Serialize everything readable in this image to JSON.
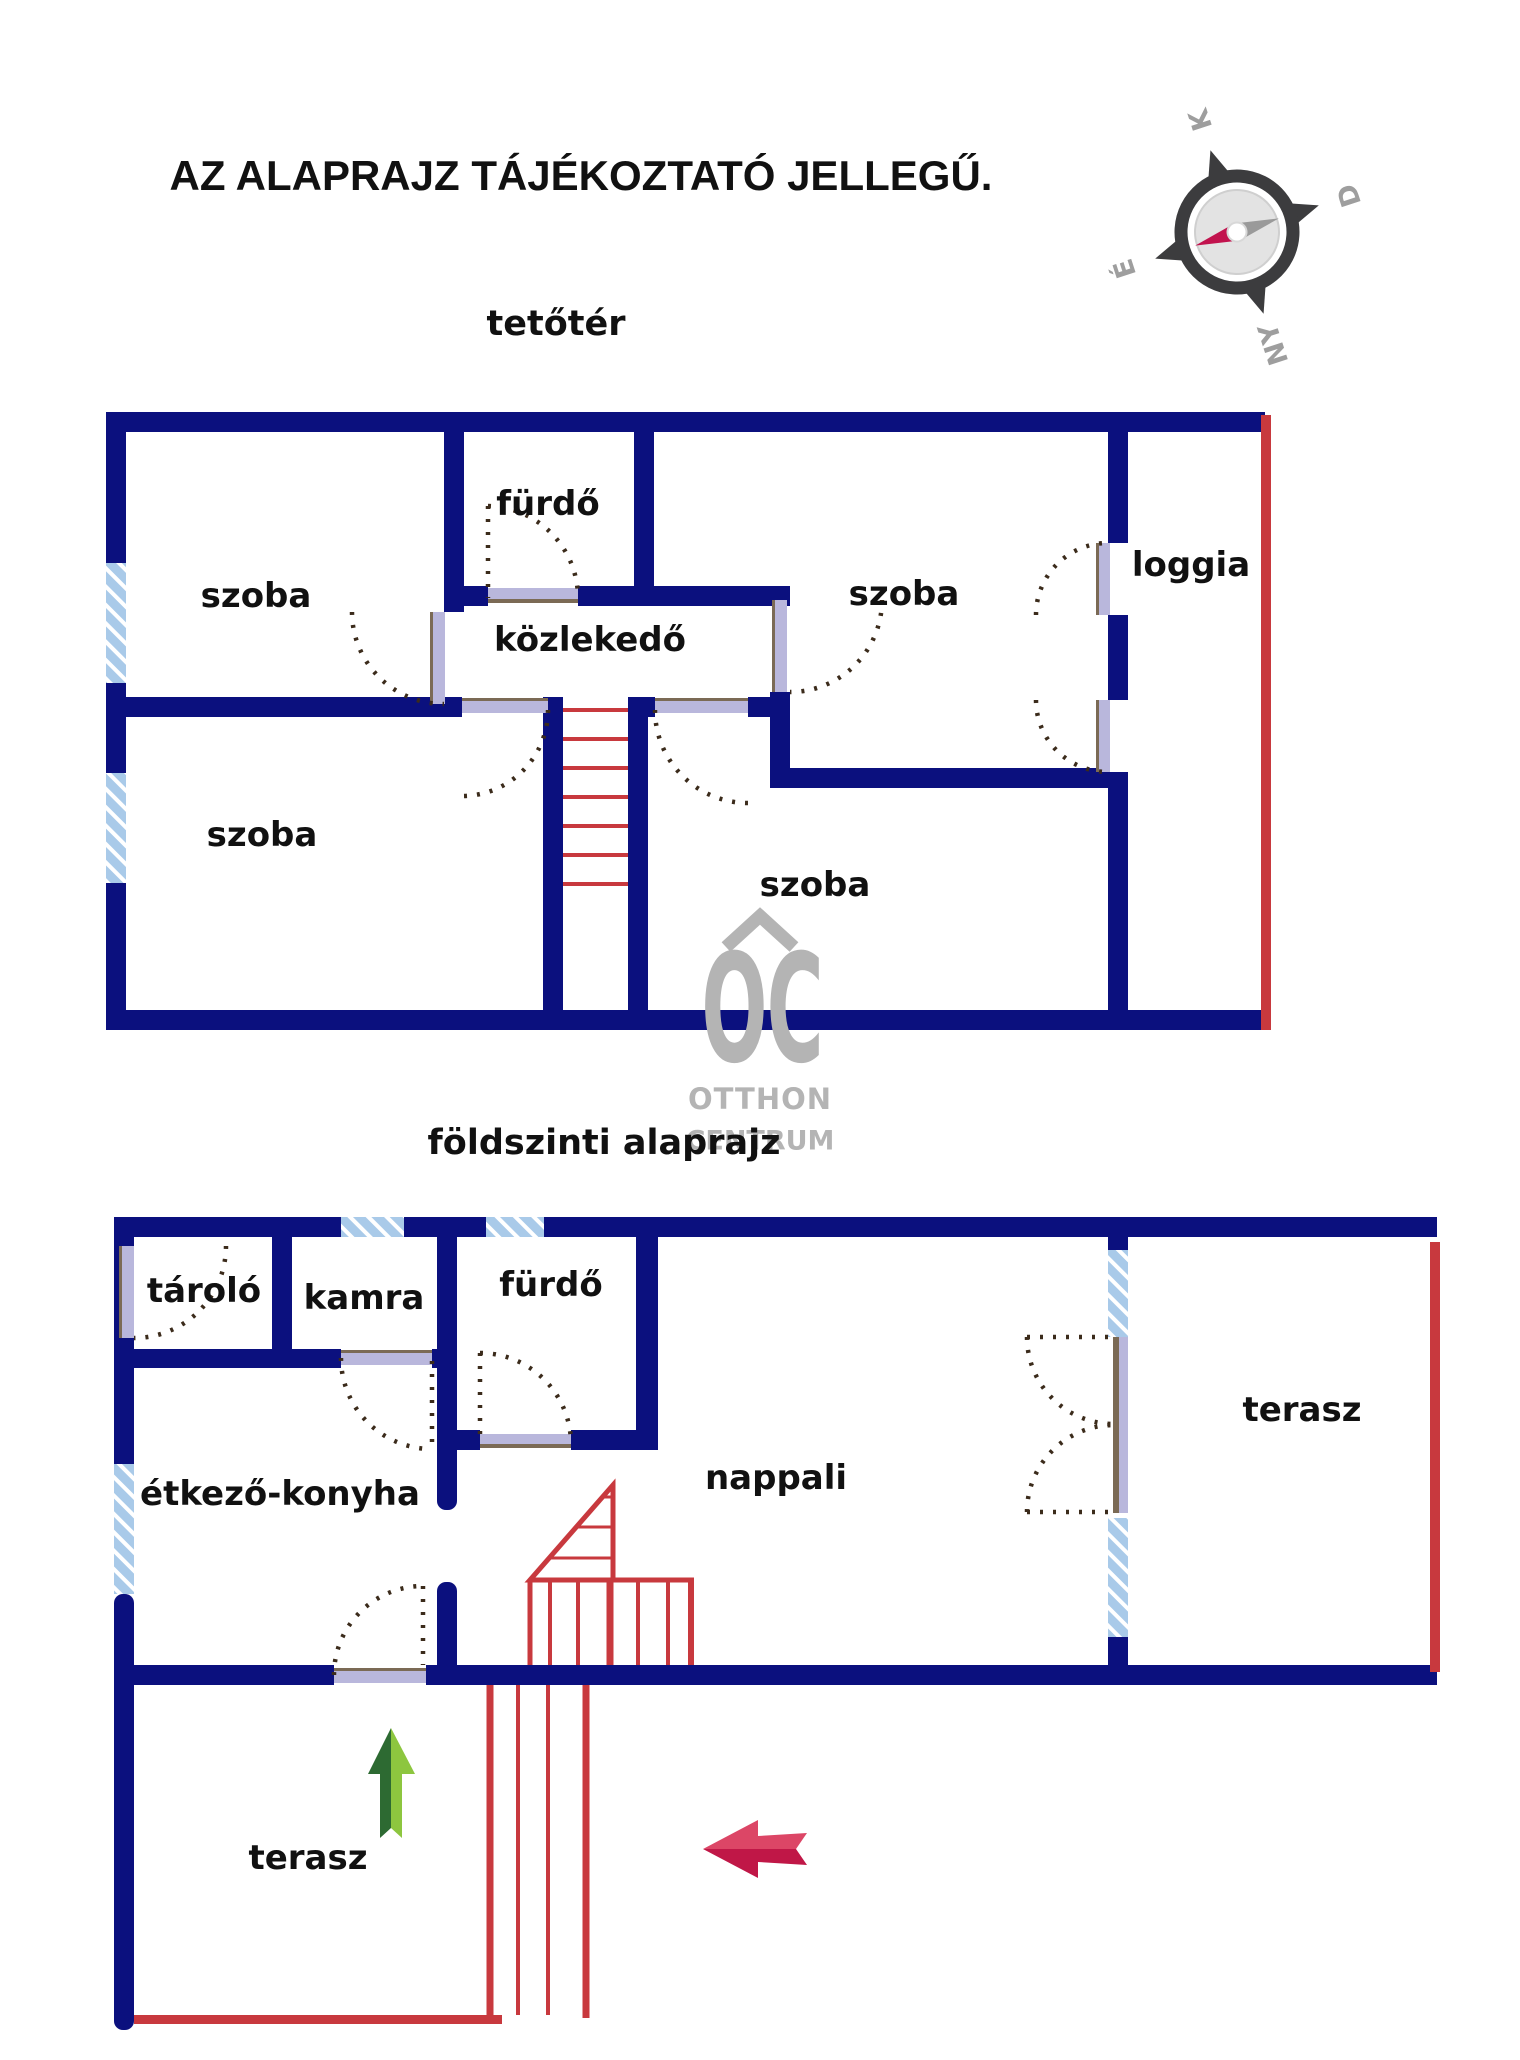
{
  "title": "AZ ALAPRAJZ TÁJÉKOZTATÓ JELLEGŰ.",
  "compass": {
    "north_label": "É",
    "east_label": "K",
    "south_label": "D",
    "west_label": "NY"
  },
  "attic": {
    "section_label": "tetőtér",
    "rooms": {
      "room_top_left": "szoba",
      "bathroom": "fürdő",
      "hall": "közlekedő",
      "room_top_right": "szoba",
      "loggia": "loggia",
      "room_bottom_left": "szoba",
      "room_bottom_right": "szoba"
    }
  },
  "ground": {
    "section_label": "földszinti alaprajz",
    "rooms": {
      "storage": "tároló",
      "pantry": "kamra",
      "bathroom": "fürdő",
      "dining_kitchen": "étkező-konyha",
      "living_room": "nappali",
      "terrace_right": "terasz",
      "terrace_bottom": "terasz"
    }
  },
  "watermark": {
    "monogram": "OC",
    "line1": "OTTHON",
    "line2": "CENTRUM"
  },
  "colors": {
    "wall_navy": "#0b107e",
    "shared_wall_red": "#c8393e",
    "window_blue": "#a9cae9",
    "door_leaf_lavender": "#b9b7dc",
    "door_frame_brown": "#7b6a55",
    "door_arc_brown": "#3b2b1b",
    "watermark_gray": "#b4b4b4",
    "compass_ring": "#3c3c3e",
    "compass_needle_red": "#c2134e",
    "compass_needle_gray": "#9a9a9a",
    "arrow_green_dark": "#2d6a32",
    "arrow_green_light": "#8dc63f",
    "arrow_pink_light": "#dc4666",
    "arrow_pink_dark": "#c01747"
  }
}
